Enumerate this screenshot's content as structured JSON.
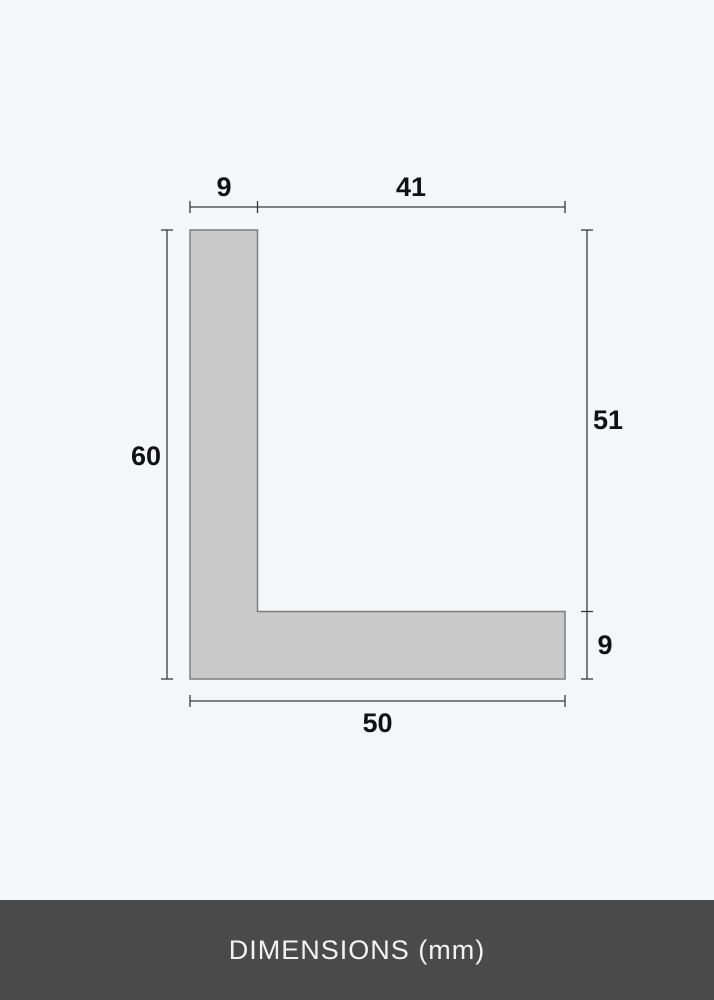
{
  "page": {
    "background_color": "#f5f6f8"
  },
  "diagram": {
    "description": "L-shaped moulding profile cross-section",
    "unit": "mm",
    "shape_fill_color": "#c9c9c9",
    "shape_stroke_color": "#7d7d7d",
    "dimension_line_color": "#3a3a3a",
    "dimensions": {
      "top_flange_width": "9",
      "top_opening_width": "41",
      "left_total_height": "60",
      "right_upper_height": "51",
      "right_base_height": "9",
      "bottom_total_width": "50"
    }
  },
  "footer": {
    "label": "DIMENSIONS (mm)",
    "background_color": "#4a4a4a",
    "text_color": "#f2f2f2"
  }
}
